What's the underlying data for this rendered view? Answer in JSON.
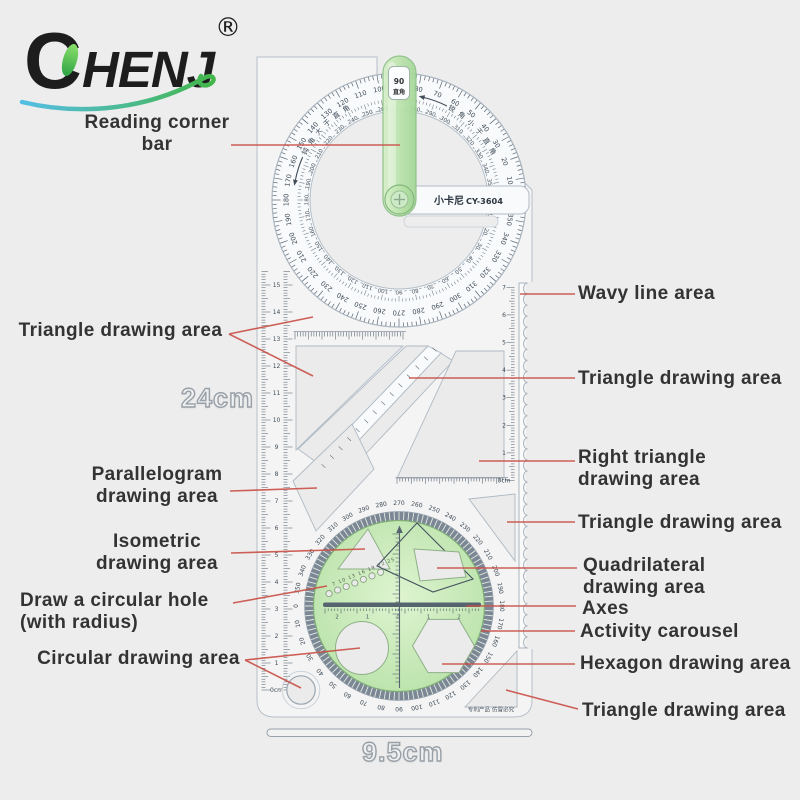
{
  "brand": {
    "first_letter": "C",
    "rest": "HENJ",
    "registered": "®"
  },
  "product": {
    "brand_cn": "小卡尼",
    "model": "CY-3604",
    "window_value": "90",
    "window_label": "直角",
    "arc_text_left": "钝角大于直角",
    "arc_text_right": "锐角小于直角",
    "patent_text": "专利产品 仿冒必究"
  },
  "dimensions": {
    "height": "24cm",
    "width": "9.5cm"
  },
  "annotations": {
    "left": [
      {
        "label": "Reading corner bar"
      },
      {
        "label": "Triangle drawing area"
      },
      {
        "label": "Parallelogram drawing area"
      },
      {
        "label": "Isometric drawing area"
      },
      {
        "label": "Draw a circular hole (with radius)"
      },
      {
        "label": "Circular drawing area"
      }
    ],
    "right": [
      {
        "label": "Wavy line area"
      },
      {
        "label": "Triangle drawing area"
      },
      {
        "label": "Right triangle drawing area"
      },
      {
        "label": "Triangle drawing area"
      },
      {
        "label": "Quadrilateral drawing area"
      },
      {
        "label": "Axes"
      },
      {
        "label": "Activity carousel"
      },
      {
        "label": "Hexagon drawing area"
      },
      {
        "label": "Triangle drawing area"
      }
    ]
  },
  "scales": {
    "protractor_outer_degrees": {
      "start": 0,
      "end": 350,
      "step": 10
    },
    "protractor_inner_degrees": {
      "start": 0,
      "end": 350,
      "step": 10
    },
    "dial_degrees": {
      "top_value": 270,
      "step": 10
    },
    "left_ruler_cm": {
      "start": 0,
      "end": 15,
      "step": 1,
      "unit": "cm"
    },
    "right_ruler_cm": {
      "start": 0,
      "end": 7,
      "step": 1,
      "unit": "cm"
    },
    "hole_diameters": [
      7,
      10,
      13,
      16,
      19,
      22,
      25
    ],
    "axis_numbers": [
      "2",
      "1",
      "0",
      "1",
      "2"
    ]
  },
  "colors": {
    "background": "#ededed",
    "body": "#f8fafc",
    "edge": "#aab4bf",
    "green_bar": "#bfe6b2",
    "green_dial": "#cdedbe",
    "gear_ring": "#7b8794",
    "annotation_line": "#c94f45",
    "label_text": "#333333",
    "swoosh_blue": "#55bee5",
    "swoosh_green": "#43b649"
  }
}
